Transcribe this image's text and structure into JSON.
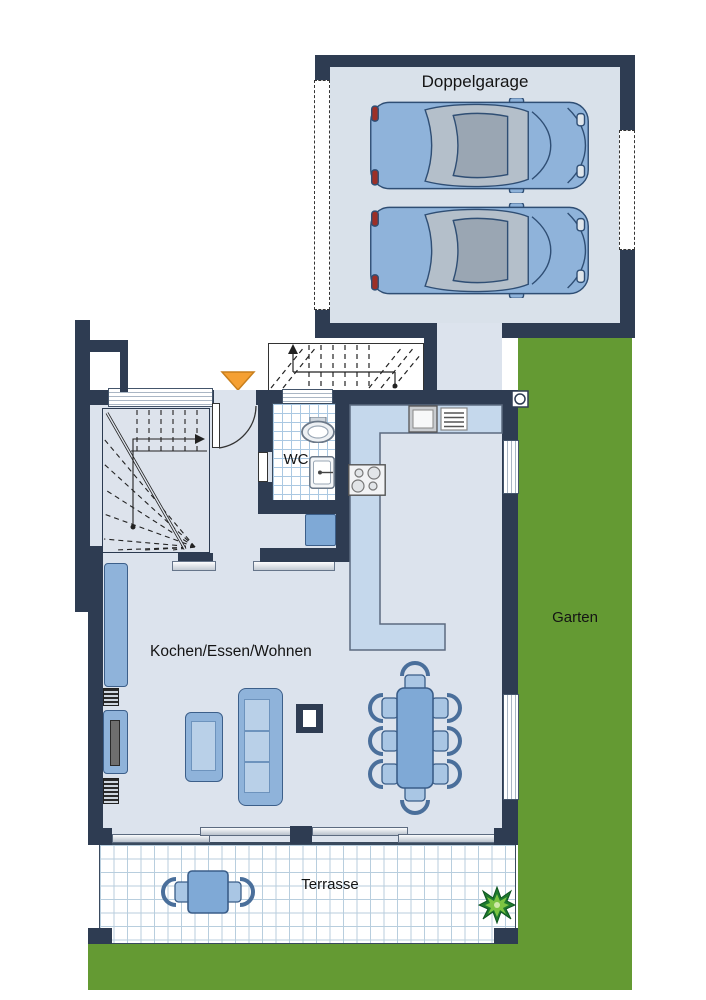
{
  "plan_title": "Erdgeschoss Grundriss",
  "rooms": {
    "garage": {
      "label": "Doppelgarage"
    },
    "garden": {
      "label": "Garten"
    },
    "hall": {
      "label": "Diele"
    },
    "wc": {
      "label": "WC"
    },
    "living": {
      "label": "Kochen/Essen/Wohnen"
    },
    "terrace": {
      "label": "Terrasse"
    }
  },
  "colors": {
    "wall": "#2e3c52",
    "floor": "#dce3ed",
    "garage_floor": "#d9e1ea",
    "garden": "#649a33",
    "counter": "#c5d8ec",
    "furniture": "#8fb3da",
    "furniture_light": "#b9d0e8",
    "furniture_dark": "#7fa9d6",
    "entrance_arrow": "#f5a033",
    "tile_line": "#aac8e2",
    "car_body": "#8fb3da"
  },
  "icons": [
    "car-icon",
    "entrance-arrow-icon",
    "stair-icon",
    "upper-stair-icon",
    "toilet-icon",
    "washbasin-icon",
    "stove-icon",
    "sink-icon",
    "sofa-icon",
    "armchair-icon",
    "fireplace-icon",
    "tv-lowboard-icon",
    "sideboard-icon",
    "dining-set-icon",
    "terrace-set-icon",
    "plant-icon",
    "outdoor-lamp-icon",
    "window-icon",
    "garage-door-icon"
  ]
}
